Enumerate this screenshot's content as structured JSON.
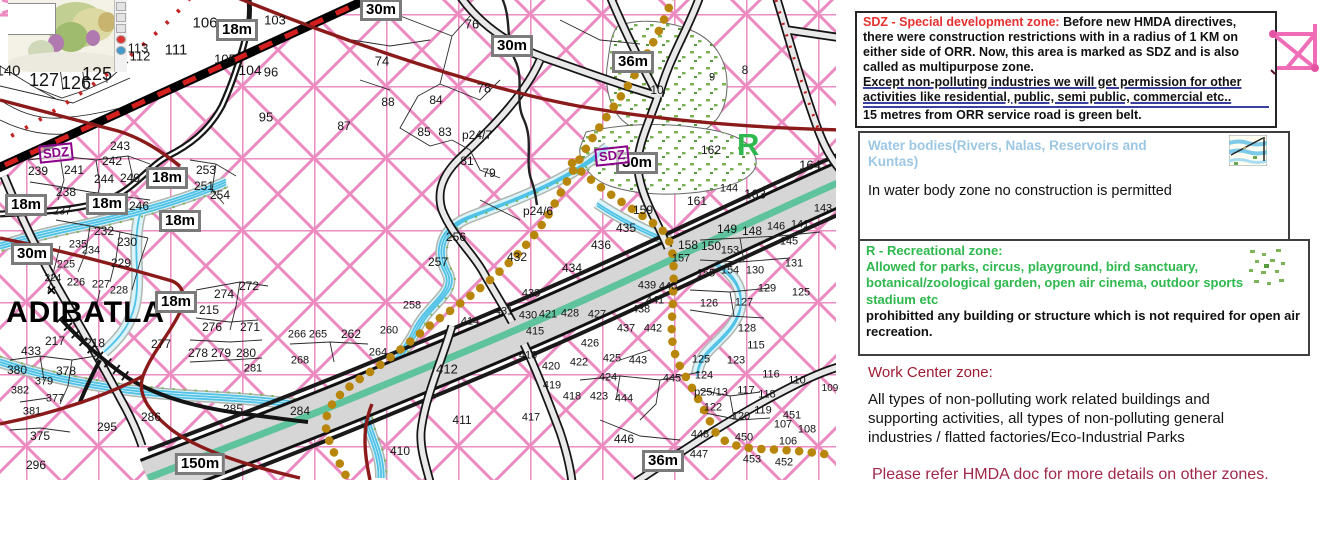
{
  "map": {
    "labels": {
      "place": "ADIBATLA",
      "recreation_letter": "R",
      "landmark": "✕"
    },
    "sdz_markers": [
      {
        "text": "SDZ",
        "x": 56,
        "y": 153
      },
      {
        "text": "SDZ",
        "x": 612,
        "y": 156
      }
    ],
    "badges": [
      [
        "18m",
        237,
        30
      ],
      [
        "30m",
        381,
        10
      ],
      [
        "30m",
        512,
        46
      ],
      [
        "36m",
        633,
        62
      ],
      [
        "30m",
        637,
        163
      ],
      [
        "18m",
        26,
        205
      ],
      [
        "18m",
        107,
        204
      ],
      [
        "18m",
        167,
        178
      ],
      [
        "18m",
        180,
        221
      ],
      [
        "30m",
        32,
        254
      ],
      [
        "18m",
        176,
        302
      ],
      [
        "150m",
        200,
        464
      ],
      [
        "36m",
        663,
        461
      ]
    ],
    "parcels": [
      [
        "106",
        205,
        23,
        15
      ],
      [
        "103",
        275,
        20,
        13
      ],
      [
        "113",
        138,
        48,
        13
      ],
      [
        "111",
        176,
        50,
        15
      ],
      [
        "112",
        140,
        56,
        13
      ],
      [
        "105",
        225,
        59,
        13
      ],
      [
        "104",
        250,
        70,
        14
      ],
      [
        "96",
        271,
        72,
        13
      ],
      [
        "95",
        266,
        117,
        13
      ],
      [
        "127",
        44,
        80,
        18
      ],
      [
        "126",
        76,
        83,
        18
      ],
      [
        "125",
        97,
        74,
        18
      ],
      [
        "140",
        8,
        71,
        15
      ],
      [
        "74",
        382,
        61,
        13
      ],
      [
        "76",
        472,
        24,
        13
      ],
      [
        "78",
        484,
        88,
        13
      ],
      [
        "84",
        436,
        100,
        12
      ],
      [
        "88",
        388,
        102,
        12
      ],
      [
        "87",
        344,
        126,
        12
      ],
      [
        "85",
        424,
        132,
        12
      ],
      [
        "83",
        445,
        132,
        12
      ],
      [
        "p24/7",
        477,
        135,
        12
      ],
      [
        "81",
        467,
        161,
        12
      ],
      [
        "79",
        489,
        173,
        12
      ],
      [
        "243",
        120,
        146,
        12
      ],
      [
        "242",
        112,
        161,
        12
      ],
      [
        "239",
        38,
        171,
        12
      ],
      [
        "241",
        74,
        170,
        12
      ],
      [
        "244",
        104,
        179,
        12
      ],
      [
        "249",
        130,
        178,
        12
      ],
      [
        "238",
        66,
        192,
        12
      ],
      [
        "246",
        139,
        206,
        12
      ],
      [
        "237",
        62,
        212,
        11
      ],
      [
        "253",
        206,
        170,
        12
      ],
      [
        "251",
        204,
        186,
        12
      ],
      [
        "254",
        220,
        195,
        12
      ],
      [
        "232",
        104,
        231,
        12
      ],
      [
        "230",
        127,
        242,
        12
      ],
      [
        "235",
        78,
        245,
        11
      ],
      [
        "234",
        91,
        251,
        11
      ],
      [
        "229",
        121,
        263,
        12
      ],
      [
        "225",
        66,
        265,
        11
      ],
      [
        "226",
        76,
        283,
        11
      ],
      [
        "227",
        101,
        285,
        11
      ],
      [
        "228",
        119,
        291,
        11
      ],
      [
        "224",
        53,
        279,
        10
      ],
      [
        "215",
        209,
        310,
        12
      ],
      [
        "274",
        224,
        294,
        12
      ],
      [
        "272",
        249,
        286,
        12
      ],
      [
        "276",
        212,
        327,
        12
      ],
      [
        "271",
        250,
        327,
        12
      ],
      [
        "277",
        161,
        344,
        12
      ],
      [
        "278",
        198,
        353,
        12
      ],
      [
        "279",
        221,
        353,
        12
      ],
      [
        "280",
        246,
        353,
        12
      ],
      [
        "281",
        253,
        369,
        11
      ],
      [
        "217",
        55,
        341,
        12
      ],
      [
        "218",
        95,
        343,
        12
      ],
      [
        "433",
        31,
        351,
        12
      ],
      [
        "380",
        17,
        370,
        12
      ],
      [
        "378",
        66,
        371,
        12
      ],
      [
        "379",
        44,
        382,
        11
      ],
      [
        "382",
        20,
        391,
        11
      ],
      [
        "377",
        55,
        399,
        11
      ],
      [
        "381",
        32,
        412,
        11
      ],
      [
        "375",
        40,
        436,
        12
      ],
      [
        "296",
        36,
        465,
        12
      ],
      [
        "295",
        107,
        427,
        12
      ],
      [
        "286",
        151,
        417,
        12
      ],
      [
        "285",
        233,
        409,
        12
      ],
      [
        "284",
        300,
        411,
        12
      ],
      [
        "256",
        456,
        237,
        12
      ],
      [
        "257",
        438,
        262,
        12
      ],
      [
        "258",
        412,
        306,
        11
      ],
      [
        "p24/6",
        538,
        211,
        12
      ],
      [
        "432",
        517,
        257,
        12
      ],
      [
        "433",
        531,
        294,
        11
      ],
      [
        "431",
        504,
        312,
        11
      ],
      [
        "430",
        528,
        316,
        11
      ],
      [
        "421",
        548,
        315,
        11
      ],
      [
        "414",
        470,
        322,
        11
      ],
      [
        "415",
        535,
        332,
        11
      ],
      [
        "416",
        528,
        356,
        11
      ],
      [
        "420",
        551,
        367,
        11
      ],
      [
        "419",
        552,
        386,
        11
      ],
      [
        "417",
        531,
        418,
        11
      ],
      [
        "412",
        447,
        369,
        13
      ],
      [
        "411",
        462,
        420,
        12
      ],
      [
        "410",
        400,
        451,
        12
      ],
      [
        "266",
        297,
        335,
        11
      ],
      [
        "265",
        318,
        335,
        11
      ],
      [
        "262",
        351,
        334,
        12
      ],
      [
        "260",
        389,
        331,
        11
      ],
      [
        "264",
        378,
        353,
        11
      ],
      [
        "268",
        300,
        361,
        11
      ],
      [
        "435",
        626,
        228,
        12
      ],
      [
        "436",
        601,
        245,
        12
      ],
      [
        "434",
        572,
        268,
        12
      ],
      [
        "163",
        755,
        194,
        13
      ],
      [
        "161",
        697,
        201,
        12
      ],
      [
        "159",
        643,
        210,
        12
      ],
      [
        "164",
        810,
        165,
        13
      ],
      [
        "162",
        711,
        150,
        12
      ],
      [
        "10",
        657,
        90,
        12
      ],
      [
        "9",
        712,
        78,
        11
      ],
      [
        "8",
        745,
        70,
        12
      ],
      [
        "144",
        729,
        189,
        11
      ],
      [
        "149",
        727,
        229,
        12
      ],
      [
        "148",
        752,
        231,
        12
      ],
      [
        "146",
        776,
        227,
        11
      ],
      [
        "141",
        800,
        225,
        11
      ],
      [
        "143",
        823,
        209,
        11
      ],
      [
        "145",
        789,
        242,
        11
      ],
      [
        "131",
        794,
        264,
        11
      ],
      [
        "158",
        688,
        245,
        12
      ],
      [
        "150",
        711,
        246,
        12
      ],
      [
        "153",
        730,
        251,
        11
      ],
      [
        "157",
        681,
        259,
        11
      ],
      [
        "155",
        706,
        274,
        11
      ],
      [
        "154",
        730,
        271,
        11
      ],
      [
        "130",
        755,
        271,
        11
      ],
      [
        "129",
        767,
        289,
        11
      ],
      [
        "125",
        801,
        293,
        11
      ],
      [
        "126",
        709,
        304,
        11
      ],
      [
        "127",
        744,
        303,
        11
      ],
      [
        "128",
        747,
        329,
        11
      ],
      [
        "115",
        756,
        346,
        11
      ],
      [
        "439",
        647,
        286,
        11
      ],
      [
        "440",
        668,
        287,
        11
      ],
      [
        "441",
        655,
        301,
        11
      ],
      [
        "438",
        641,
        310,
        11
      ],
      [
        "428",
        570,
        314,
        11
      ],
      [
        "427",
        597,
        315,
        11
      ],
      [
        "437",
        626,
        329,
        11
      ],
      [
        "442",
        653,
        329,
        11
      ],
      [
        "426",
        590,
        344,
        11
      ],
      [
        "422",
        579,
        363,
        11
      ],
      [
        "425",
        612,
        359,
        11
      ],
      [
        "443",
        638,
        361,
        11
      ],
      [
        "424",
        608,
        378,
        11
      ],
      [
        "418",
        572,
        397,
        11
      ],
      [
        "423",
        599,
        397,
        11
      ],
      [
        "444",
        624,
        399,
        11
      ],
      [
        "445",
        672,
        379,
        11
      ],
      [
        "124",
        704,
        376,
        11
      ],
      [
        "125",
        701,
        360,
        11
      ],
      [
        "123",
        736,
        361,
        11
      ],
      [
        "116",
        771,
        375,
        11
      ],
      [
        "110",
        797,
        381,
        11
      ],
      [
        "117",
        746,
        391,
        11
      ],
      [
        "118",
        767,
        395,
        11
      ],
      [
        "109",
        830,
        389,
        10
      ],
      [
        "p25/13",
        711,
        393,
        11
      ],
      [
        "122",
        713,
        408,
        11
      ],
      [
        "119",
        763,
        411,
        11
      ],
      [
        "120",
        741,
        417,
        11
      ],
      [
        "451",
        792,
        416,
        11
      ],
      [
        "107",
        783,
        425,
        11
      ],
      [
        "108",
        807,
        430,
        11
      ],
      [
        "446",
        624,
        439,
        12
      ],
      [
        "448",
        700,
        435,
        11
      ],
      [
        "450",
        744,
        438,
        11
      ],
      [
        "447",
        699,
        455,
        11
      ],
      [
        "453",
        752,
        460,
        11
      ],
      [
        "106",
        788,
        442,
        11
      ],
      [
        "452",
        784,
        463,
        11
      ]
    ],
    "colors": {
      "grid_pink": "#ec8ac2",
      "orr_teal": "#5fc39e",
      "road_gray": "#d6d6d6",
      "water_blue": "#4fc2e6",
      "gold_boundary": "#b8860b",
      "dark_red_road": "#8b1a1a",
      "railway_red": "#d41f1f",
      "recreation_green": "#2eb84d",
      "sdz_purple": "#8b008b"
    }
  },
  "panel": {
    "sdz_box": {
      "title": "SDZ - Special development zone:",
      "body": "Before new HMDA directives, there were construction restrictions with in a radius of 1 KM on either side of ORR. Now, this area is marked as SDZ and is also called as multipurpose zone.",
      "underlined": "Except non-polluting industries we will get permission for other activities like residential, public, semi public, commercial etc..",
      "footer": "15 metres from ORR service road is green belt."
    },
    "water_box": {
      "title": "Water bodies(Rivers, Nalas, Reservoirs and Kuntas)",
      "body": "In water body zone no construction is permitted"
    },
    "recreation_box": {
      "title": "R - Recreational zone:",
      "allowed": "Allowed for parks, circus, playground, bird sanctuary, botanical/zoological garden, open air cinema, outdoor sports stadium etc",
      "prohibited": "prohibitted any building or structure which is not required for open air recreation."
    },
    "work_center": {
      "title": "Work Center zone:",
      "body": "All types of non-polluting work related buildings and supporting activities, all types of non-polluting general industries / flatted factories/Eco-Industrial Parks"
    },
    "note": "Please refer HMDA doc for more details on other zones."
  }
}
